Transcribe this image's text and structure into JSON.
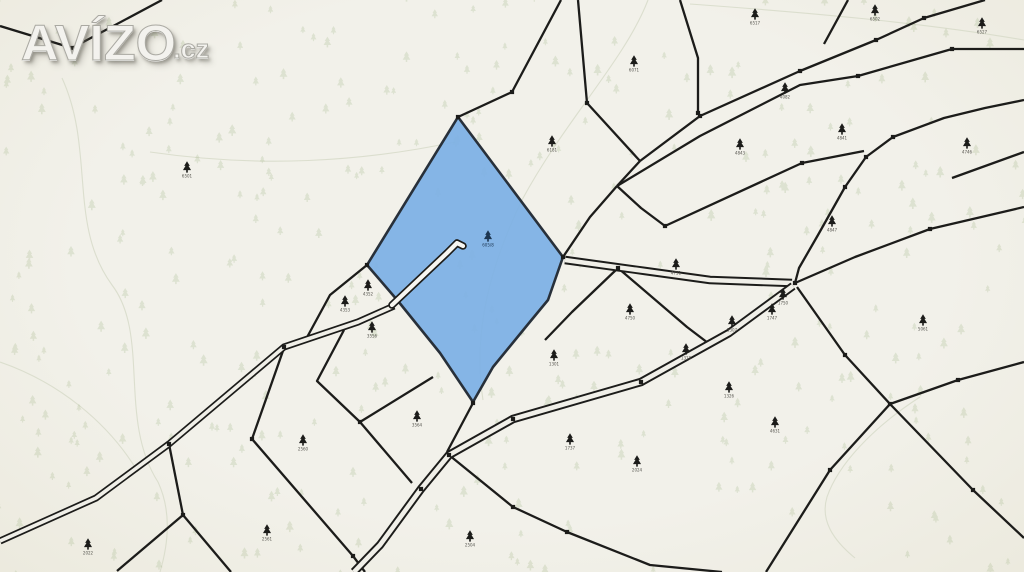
{
  "watermark": {
    "text": "AVÍZO",
    "suffix": ".cz"
  },
  "colors": {
    "background": "#f0efe8",
    "boundary_line": "#1c1c1a",
    "highlight_fill": "#7cb0e5",
    "highlight_stroke": "#17202b",
    "forest_symbol": "#a9bc91",
    "contour_line": "#d7dac9",
    "parcel_number": "#55544e",
    "road_inner": "#f0efe8",
    "sliver_inner": "#f7f6f1",
    "highlight_label": "#1c3550"
  },
  "map": {
    "width": 1024,
    "height": 572,
    "contours": [
      "M 62,78 C 95,150 68,225 112,285 C 150,335 118,420 158,482 C 172,512 168,545 160,572",
      "M 648,0 C 625,60 565,120 522,200 C 492,262 472,330 483,400",
      "M 690,4 C 800,12 920,22 1024,40",
      "M 150,152 C 260,168 360,162 455,142",
      "M 920,397 C 872,428 838,465 827,497 C 820,520 833,540 855,558",
      "M 0,362 C 58,382 108,422 138,472"
    ],
    "boundaries": [
      [
        [
          162,
          0
        ],
        [
          72,
          48
        ],
        [
          0,
          26
        ]
      ],
      [
        [
          578,
          0
        ],
        [
          587,
          103
        ],
        [
          640,
          161
        ]
      ],
      [
        [
          680,
          0
        ],
        [
          698,
          58
        ],
        [
          698,
          113
        ]
      ],
      [
        [
          640,
          161
        ],
        [
          700,
          116
        ],
        [
          800,
          71
        ],
        [
          876,
          40
        ],
        [
          924,
          18
        ],
        [
          985,
          0
        ]
      ],
      [
        [
          617,
          186
        ],
        [
          700,
          136
        ],
        [
          800,
          85
        ],
        [
          858,
          76
        ],
        [
          952,
          49
        ],
        [
          1024,
          49
        ]
      ],
      [
        [
          640,
          161
        ],
        [
          617,
          186
        ]
      ],
      [
        [
          617,
          186
        ],
        [
          641,
          208
        ],
        [
          665,
          226
        ],
        [
          802,
          163
        ],
        [
          864,
          151
        ]
      ],
      [
        [
          617,
          186
        ],
        [
          590,
          217
        ],
        [
          563,
          257
        ]
      ],
      [
        [
          848,
          0
        ],
        [
          824,
          44
        ]
      ],
      [
        [
          1024,
          100
        ],
        [
          985,
          108
        ],
        [
          944,
          118
        ],
        [
          893,
          137
        ],
        [
          866,
          157
        ],
        [
          845,
          187
        ],
        [
          818,
          235
        ],
        [
          799,
          268
        ],
        [
          795,
          283
        ]
      ],
      [
        [
          795,
          283
        ],
        [
          855,
          257
        ],
        [
          930,
          229
        ],
        [
          1024,
          207
        ]
      ],
      [
        [
          952,
          178
        ],
        [
          1024,
          152
        ]
      ],
      [
        [
          473,
          403
        ],
        [
          447,
          452
        ]
      ],
      [
        [
          433,
          377
        ],
        [
          360,
          422
        ]
      ],
      [
        [
          360,
          422
        ],
        [
          412,
          483
        ]
      ],
      [
        [
          360,
          422
        ],
        [
          317,
          381
        ],
        [
          344,
          330
        ]
      ],
      [
        [
          169,
          444
        ],
        [
          183,
          515
        ]
      ],
      [
        [
          183,
          515
        ],
        [
          117,
          571
        ]
      ],
      [
        [
          183,
          515
        ],
        [
          231,
          572
        ]
      ],
      [
        [
          284,
          348
        ],
        [
          252,
          439
        ]
      ],
      [
        [
          252,
          439
        ],
        [
          353,
          556
        ],
        [
          365,
          572
        ]
      ],
      [
        [
          449,
          455
        ],
        [
          513,
          507
        ],
        [
          567,
          532
        ],
        [
          650,
          565
        ],
        [
          722,
          572
        ]
      ],
      [
        [
          797,
          287
        ],
        [
          845,
          355
        ],
        [
          890,
          404
        ]
      ],
      [
        [
          890,
          404
        ],
        [
          973,
          490
        ],
        [
          1024,
          538
        ]
      ],
      [
        [
          890,
          404
        ],
        [
          830,
          470
        ],
        [
          766,
          572
        ]
      ],
      [
        [
          890,
          404
        ],
        [
          958,
          380
        ],
        [
          1024,
          362
        ]
      ],
      [
        [
          367,
          265
        ],
        [
          330,
          295
        ],
        [
          305,
          341
        ]
      ],
      [
        [
          458,
          117
        ],
        [
          512,
          92
        ],
        [
          561,
          0
        ]
      ],
      [
        [
          618,
          268
        ],
        [
          572,
          312
        ],
        [
          545,
          340
        ]
      ],
      [
        [
          618,
          268
        ],
        [
          687,
          327
        ],
        [
          712,
          346
        ]
      ]
    ],
    "roads": [
      {
        "pts": [
          [
            394,
            306
          ],
          [
            358,
            322
          ],
          [
            284,
            347
          ],
          [
            169,
            444
          ],
          [
            96,
            498
          ],
          [
            0,
            541
          ]
        ],
        "outer": 7,
        "inner": 3.6,
        "fill": "road_inner"
      },
      {
        "pts": [
          [
            565,
            260
          ],
          [
            645,
            271
          ],
          [
            710,
            280
          ],
          [
            792,
            283
          ]
        ],
        "outer": 8.5,
        "inner": 4.6,
        "fill": "road_inner"
      },
      {
        "pts": [
          [
            793,
            286
          ],
          [
            729,
            333
          ],
          [
            641,
            382
          ],
          [
            513,
            419
          ],
          [
            449,
            455
          ],
          [
            421,
            489
          ],
          [
            380,
            545
          ],
          [
            354,
            572
          ]
        ],
        "outer": 8.5,
        "inner": 4.6,
        "fill": "road_inner"
      }
    ],
    "highlight": {
      "polygon": [
        [
          458,
          117
        ],
        [
          563,
          257
        ],
        [
          548,
          300
        ],
        [
          529,
          323
        ],
        [
          493,
          367
        ],
        [
          473,
          402
        ],
        [
          440,
          353
        ],
        [
          398,
          301
        ],
        [
          367,
          265
        ]
      ],
      "sliver": [
        [
          392,
          305
        ],
        [
          447,
          253
        ],
        [
          457,
          243
        ],
        [
          463,
          246
        ]
      ],
      "marker": {
        "x": 488,
        "y": 237,
        "n": "605/8"
      }
    },
    "nodes": [
      [
        72,
        48
      ],
      [
        587,
        103
      ],
      [
        698,
        113
      ],
      [
        700,
        116
      ],
      [
        800,
        71
      ],
      [
        876,
        40
      ],
      [
        924,
        18
      ],
      [
        858,
        76
      ],
      [
        952,
        49
      ],
      [
        893,
        137
      ],
      [
        866,
        157
      ],
      [
        845,
        187
      ],
      [
        795,
        283
      ],
      [
        641,
        382
      ],
      [
        513,
        419
      ],
      [
        449,
        455
      ],
      [
        421,
        489
      ],
      [
        360,
        422
      ],
      [
        845,
        355
      ],
      [
        890,
        404
      ],
      [
        973,
        490
      ],
      [
        830,
        470
      ],
      [
        958,
        380
      ],
      [
        930,
        229
      ],
      [
        567,
        532
      ],
      [
        513,
        507
      ],
      [
        284,
        347
      ],
      [
        169,
        444
      ],
      [
        183,
        515
      ],
      [
        252,
        439
      ],
      [
        353,
        556
      ],
      [
        563,
        257
      ],
      [
        473,
        403
      ],
      [
        458,
        117
      ],
      [
        367,
        265
      ],
      [
        665,
        226
      ],
      [
        802,
        163
      ],
      [
        618,
        268
      ],
      [
        512,
        92
      ]
    ],
    "parcels": [
      {
        "x": 187,
        "y": 168,
        "n": "6501"
      },
      {
        "x": 755,
        "y": 15,
        "n": "6517"
      },
      {
        "x": 875,
        "y": 11,
        "n": "6502"
      },
      {
        "x": 982,
        "y": 24,
        "n": "6527"
      },
      {
        "x": 634,
        "y": 62,
        "n": "6071"
      },
      {
        "x": 785,
        "y": 89,
        "n": "4082"
      },
      {
        "x": 552,
        "y": 142,
        "n": "6181"
      },
      {
        "x": 842,
        "y": 130,
        "n": "4841"
      },
      {
        "x": 967,
        "y": 144,
        "n": "4746"
      },
      {
        "x": 740,
        "y": 145,
        "n": "4843"
      },
      {
        "x": 832,
        "y": 222,
        "n": "4847"
      },
      {
        "x": 676,
        "y": 265,
        "n": "4751"
      },
      {
        "x": 630,
        "y": 310,
        "n": "4750"
      },
      {
        "x": 368,
        "y": 286,
        "n": "4352"
      },
      {
        "x": 345,
        "y": 302,
        "n": "4353"
      },
      {
        "x": 372,
        "y": 328,
        "n": "3556"
      },
      {
        "x": 417,
        "y": 417,
        "n": "3564"
      },
      {
        "x": 303,
        "y": 441,
        "n": "2560"
      },
      {
        "x": 267,
        "y": 531,
        "n": "2561"
      },
      {
        "x": 88,
        "y": 545,
        "n": "2022"
      },
      {
        "x": 470,
        "y": 537,
        "n": "2504"
      },
      {
        "x": 570,
        "y": 440,
        "n": "1737"
      },
      {
        "x": 637,
        "y": 462,
        "n": "2024"
      },
      {
        "x": 554,
        "y": 356,
        "n": "1301"
      },
      {
        "x": 686,
        "y": 350,
        "n": "1318"
      },
      {
        "x": 732,
        "y": 322,
        "n": "5307"
      },
      {
        "x": 772,
        "y": 310,
        "n": "1747"
      },
      {
        "x": 783,
        "y": 295,
        "n": "1750"
      },
      {
        "x": 729,
        "y": 388,
        "n": "1326"
      },
      {
        "x": 775,
        "y": 423,
        "n": "4631"
      },
      {
        "x": 923,
        "y": 321,
        "n": "5061"
      }
    ],
    "forest_pattern": {
      "count": 380,
      "seed": 7
    }
  }
}
